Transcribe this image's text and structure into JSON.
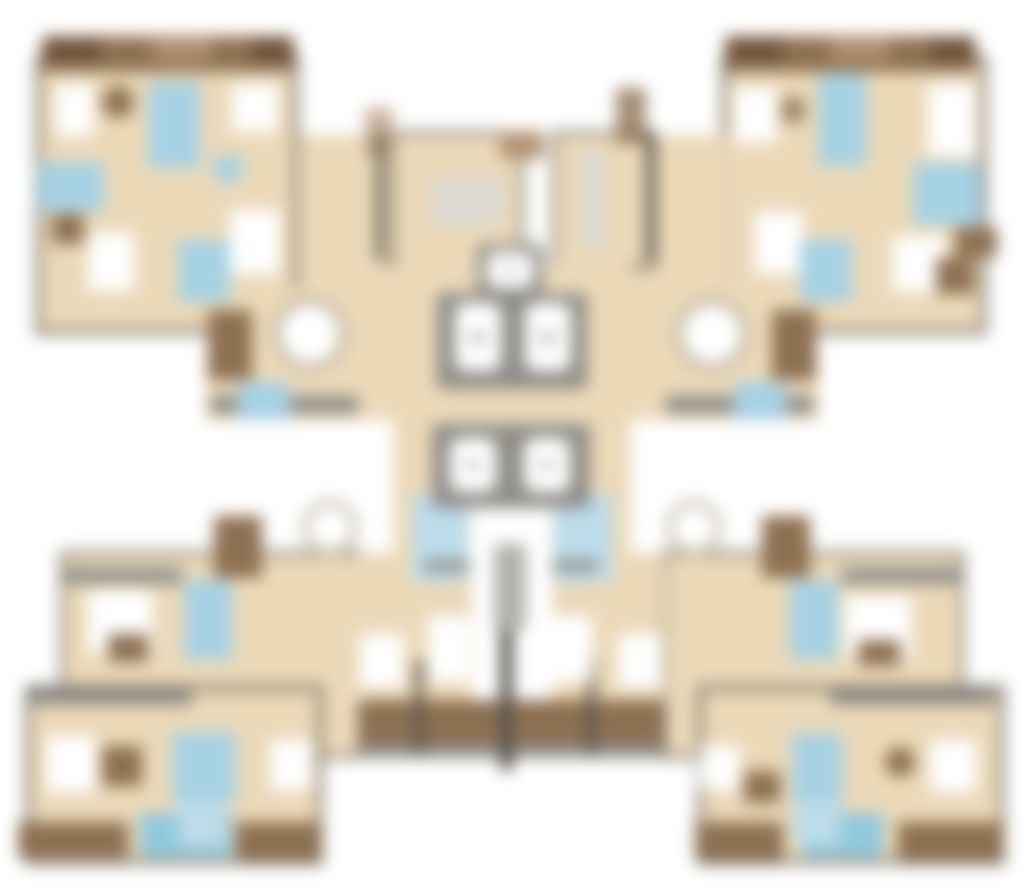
{
  "meta": {
    "title": "Blurred residential tower floor plan",
    "description": "Heavily blurred architectural floor plan: four corner apartment units around a central elevator and stair core. No legible text is rendered in the image.",
    "legible_text": []
  },
  "canvas": {
    "width": 1024,
    "height": 896,
    "background": "#ffffff",
    "blur_px": 8
  },
  "palette": {
    "white": "#ffffff",
    "beige": "#ebd9b8",
    "brown": "#8d7051",
    "dkbrown": "#6e5339",
    "tan": "#b29372",
    "blue": "#a7d2e4",
    "blue2": "#8fc8de",
    "blue3": "#bcdcea",
    "gray": "#8f8d88",
    "gray2": "#b3b1ac",
    "lgray": "#dcdad2",
    "wall": "#6e685d",
    "wall2": "#57534b",
    "ring": "#b9af99"
  },
  "legend": {
    "beige": "apartment floor area",
    "white": "rooms / bedrooms / elevator cabs",
    "blue": "bathrooms and wet areas",
    "brown": "terraces, balconies, furniture",
    "gray": "core walls, railings, stair flight"
  },
  "shapes": [
    {
      "n": "tl-corner-unit-floor",
      "t": "r",
      "x": 38,
      "y": 58,
      "w": 258,
      "h": 274,
      "f": "beige",
      "s": "wall",
      "sw": 5
    },
    {
      "n": "tr-corner-unit-floor",
      "t": "r",
      "x": 724,
      "y": 58,
      "w": 260,
      "h": 274,
      "f": "beige",
      "s": "wall",
      "sw": 5
    },
    {
      "n": "tl-extension-floor-a",
      "t": "r",
      "x": 298,
      "y": 135,
      "w": 96,
      "h": 152,
      "f": "beige"
    },
    {
      "n": "tl-extension-floor-b",
      "t": "r",
      "x": 206,
      "y": 287,
      "w": 188,
      "h": 133,
      "f": "beige"
    },
    {
      "n": "tr-extension-floor-a",
      "t": "r",
      "x": 630,
      "y": 135,
      "w": 96,
      "h": 152,
      "f": "beige"
    },
    {
      "n": "tr-extension-floor-b",
      "t": "r",
      "x": 630,
      "y": 287,
      "w": 188,
      "h": 133,
      "f": "beige"
    },
    {
      "n": "center-top-left-floor",
      "t": "r",
      "x": 392,
      "y": 133,
      "w": 130,
      "h": 134,
      "f": "beige",
      "s": "wall",
      "sw": 4
    },
    {
      "n": "center-top-right-floor",
      "t": "r",
      "x": 554,
      "y": 133,
      "w": 100,
      "h": 134,
      "f": "beige",
      "s": "wall",
      "sw": 4
    },
    {
      "n": "center-core-floor",
      "t": "r",
      "x": 394,
      "y": 264,
      "w": 236,
      "h": 296,
      "f": "beige"
    },
    {
      "n": "bl-intermediate-floor",
      "t": "r",
      "x": 62,
      "y": 553,
      "w": 298,
      "h": 204,
      "f": "beige",
      "s": "wall",
      "sw": 4
    },
    {
      "n": "br-intermediate-floor",
      "t": "r",
      "x": 664,
      "y": 553,
      "w": 298,
      "h": 204,
      "f": "beige",
      "s": "wall",
      "sw": 4
    },
    {
      "n": "bc-left-unit-floor",
      "t": "r",
      "x": 358,
      "y": 553,
      "w": 114,
      "h": 150,
      "f": "beige"
    },
    {
      "n": "bc-right-unit-floor",
      "t": "r",
      "x": 552,
      "y": 553,
      "w": 112,
      "h": 150,
      "f": "beige"
    },
    {
      "n": "bl-corner-unit-floor",
      "t": "r",
      "x": 28,
      "y": 688,
      "w": 292,
      "h": 174,
      "f": "beige",
      "s": "wall",
      "sw": 5
    },
    {
      "n": "br-corner-unit-floor",
      "t": "r",
      "x": 700,
      "y": 688,
      "w": 302,
      "h": 174,
      "f": "beige",
      "s": "wall",
      "sw": 5
    },
    {
      "n": "tl-terrace-band",
      "t": "r",
      "x": 42,
      "y": 36,
      "w": 250,
      "h": 36,
      "f": "brown"
    },
    {
      "n": "tl-terrace-dark-left",
      "t": "r",
      "x": 45,
      "y": 38,
      "w": 55,
      "h": 24,
      "f": "dkbrown"
    },
    {
      "n": "tl-terrace-light-mid",
      "t": "r",
      "x": 152,
      "y": 40,
      "w": 60,
      "h": 20,
      "f": "tan"
    },
    {
      "n": "tl-terrace-dark-right",
      "t": "r",
      "x": 252,
      "y": 38,
      "w": 42,
      "h": 24,
      "f": "dkbrown"
    },
    {
      "n": "tr-terrace-band",
      "t": "r",
      "x": 725,
      "y": 36,
      "w": 250,
      "h": 36,
      "f": "brown"
    },
    {
      "n": "tr-terrace-dark-left",
      "t": "r",
      "x": 728,
      "y": 38,
      "w": 55,
      "h": 24,
      "f": "dkbrown"
    },
    {
      "n": "tr-terrace-light-mid",
      "t": "r",
      "x": 830,
      "y": 40,
      "w": 60,
      "h": 20,
      "f": "tan"
    },
    {
      "n": "tr-terrace-dark-right",
      "t": "r",
      "x": 930,
      "y": 38,
      "w": 45,
      "h": 24,
      "f": "dkbrown"
    },
    {
      "n": "tl-balcony-block",
      "t": "r",
      "x": 208,
      "y": 310,
      "w": 44,
      "h": 70,
      "f": "brown"
    },
    {
      "n": "tr-balcony-block",
      "t": "r",
      "x": 772,
      "y": 310,
      "w": 44,
      "h": 70,
      "f": "brown"
    },
    {
      "n": "tl-railing",
      "t": "r",
      "x": 210,
      "y": 396,
      "w": 148,
      "h": 18,
      "f": "gray"
    },
    {
      "n": "tr-railing",
      "t": "r",
      "x": 666,
      "y": 396,
      "w": 148,
      "h": 18,
      "f": "gray"
    },
    {
      "n": "ct-deco-left",
      "t": "r",
      "x": 365,
      "y": 108,
      "w": 28,
      "h": 48,
      "f": "tan",
      "o": 0.7
    },
    {
      "n": "ct-deco-right",
      "t": "r",
      "x": 616,
      "y": 88,
      "w": 30,
      "h": 56,
      "f": "brown",
      "o": 0.8
    },
    {
      "n": "ct-top-brown-mark",
      "t": "r",
      "x": 500,
      "y": 131,
      "w": 44,
      "h": 28,
      "f": "tan"
    },
    {
      "n": "ct-wall-left",
      "t": "r",
      "x": 376,
      "y": 133,
      "w": 7,
      "h": 128,
      "f": "wall2"
    },
    {
      "n": "ct-wall-right",
      "t": "r",
      "x": 646,
      "y": 133,
      "w": 7,
      "h": 128,
      "f": "wall2"
    },
    {
      "n": "bl-intermediate-top-wall",
      "t": "r",
      "x": 62,
      "y": 568,
      "w": 120,
      "h": 16,
      "f": "gray"
    },
    {
      "n": "br-intermediate-top-wall",
      "t": "r",
      "x": 842,
      "y": 568,
      "w": 120,
      "h": 16,
      "f": "gray"
    },
    {
      "n": "bl-corner-top-wall",
      "t": "r",
      "x": 28,
      "y": 690,
      "w": 164,
      "h": 15,
      "f": "gray"
    },
    {
      "n": "br-corner-top-wall",
      "t": "r",
      "x": 830,
      "y": 690,
      "w": 164,
      "h": 15,
      "f": "gray"
    },
    {
      "n": "bc-balcony-band",
      "t": "r",
      "x": 360,
      "y": 700,
      "w": 302,
      "h": 44,
      "f": "brown"
    },
    {
      "n": "bc-railing",
      "t": "r",
      "x": 360,
      "y": 744,
      "w": 302,
      "h": 14,
      "f": "gray"
    },
    {
      "n": "bc-mullion-left",
      "t": "r",
      "x": 414,
      "y": 660,
      "w": 10,
      "h": 94,
      "f": "wall2",
      "o": 0.8
    },
    {
      "n": "bc-mullion-right",
      "t": "r",
      "x": 586,
      "y": 660,
      "w": 10,
      "h": 94,
      "f": "wall2",
      "o": 0.8
    },
    {
      "n": "bc-party-wall-divider",
      "t": "r",
      "x": 500,
      "y": 556,
      "w": 13,
      "h": 214,
      "f": "wall2"
    },
    {
      "n": "bl-bottom-band-brown-1",
      "t": "r",
      "x": 18,
      "y": 822,
      "w": 110,
      "h": 36,
      "f": "brown"
    },
    {
      "n": "bl-bottom-band-blue",
      "t": "r",
      "x": 140,
      "y": 813,
      "w": 92,
      "h": 44,
      "f": "blue2"
    },
    {
      "n": "bl-bottom-band-brown-2",
      "t": "r",
      "x": 236,
      "y": 822,
      "w": 84,
      "h": 38,
      "f": "brown"
    },
    {
      "n": "br-bottom-band-brown-1",
      "t": "r",
      "x": 695,
      "y": 822,
      "w": 88,
      "h": 38,
      "f": "brown"
    },
    {
      "n": "br-bottom-band-blue",
      "t": "r",
      "x": 803,
      "y": 813,
      "w": 80,
      "h": 44,
      "f": "blue2"
    },
    {
      "n": "br-bottom-band-brown-2",
      "t": "r",
      "x": 898,
      "y": 822,
      "w": 106,
      "h": 38,
      "f": "brown"
    },
    {
      "n": "tl-bedroom-1",
      "t": "r",
      "x": 56,
      "y": 84,
      "w": 38,
      "h": 52,
      "f": "white"
    },
    {
      "n": "tl-bathroom-1",
      "t": "r",
      "x": 148,
      "y": 82,
      "w": 52,
      "h": 86,
      "f": "blue"
    },
    {
      "n": "tl-bedroom-2",
      "t": "r",
      "x": 232,
      "y": 84,
      "w": 46,
      "h": 48,
      "f": "white"
    },
    {
      "n": "tl-wet-small",
      "t": "r",
      "x": 214,
      "y": 156,
      "w": 28,
      "h": 26,
      "f": "blue"
    },
    {
      "n": "tl-bathroom-2",
      "t": "r",
      "x": 38,
      "y": 162,
      "w": 66,
      "h": 50,
      "f": "blue"
    },
    {
      "n": "tl-bedroom-3",
      "t": "r",
      "x": 88,
      "y": 233,
      "w": 46,
      "h": 58,
      "f": "white"
    },
    {
      "n": "tl-ext-bedroom",
      "t": "r",
      "x": 230,
      "y": 210,
      "w": 50,
      "h": 64,
      "f": "white"
    },
    {
      "n": "tl-ext-bathroom",
      "t": "r",
      "x": 178,
      "y": 240,
      "w": 52,
      "h": 62,
      "f": "blue"
    },
    {
      "n": "tl-ext-wet-area",
      "t": "r",
      "x": 238,
      "y": 382,
      "w": 52,
      "h": 38,
      "f": "blue"
    },
    {
      "n": "tr-bedroom-1",
      "t": "r",
      "x": 733,
      "y": 88,
      "w": 44,
      "h": 54,
      "f": "white"
    },
    {
      "n": "tr-bathroom-1",
      "t": "r",
      "x": 818,
      "y": 74,
      "w": 48,
      "h": 92,
      "f": "blue"
    },
    {
      "n": "tr-bedroom-2",
      "t": "r",
      "x": 928,
      "y": 84,
      "w": 48,
      "h": 72,
      "f": "white"
    },
    {
      "n": "tr-bathroom-2",
      "t": "r",
      "x": 913,
      "y": 163,
      "w": 68,
      "h": 62,
      "f": "blue"
    },
    {
      "n": "tr-bedroom-3",
      "t": "r",
      "x": 893,
      "y": 236,
      "w": 52,
      "h": 56,
      "f": "white"
    },
    {
      "n": "tr-ext-bedroom",
      "t": "r",
      "x": 755,
      "y": 212,
      "w": 48,
      "h": 62,
      "f": "white"
    },
    {
      "n": "tr-ext-bathroom",
      "t": "r",
      "x": 800,
      "y": 240,
      "w": 52,
      "h": 62,
      "f": "blue"
    },
    {
      "n": "tr-ext-wet-area",
      "t": "r",
      "x": 734,
      "y": 382,
      "w": 52,
      "h": 38,
      "f": "blue"
    },
    {
      "n": "ct-kitchen-counter",
      "t": "r",
      "x": 432,
      "y": 178,
      "w": 72,
      "h": 48,
      "f": "lgray"
    },
    {
      "n": "ct-corridor-strip",
      "t": "r",
      "x": 580,
      "y": 150,
      "w": 26,
      "h": 98,
      "f": "lgray"
    },
    {
      "n": "stair-wet-left",
      "t": "r",
      "x": 412,
      "y": 494,
      "w": 56,
      "h": 88,
      "f": "blue3"
    },
    {
      "n": "stair-wet-right",
      "t": "r",
      "x": 554,
      "y": 494,
      "w": 58,
      "h": 88,
      "f": "blue3"
    },
    {
      "n": "stairwell",
      "t": "r",
      "x": 470,
      "y": 500,
      "w": 82,
      "h": 74,
      "f": "white"
    },
    {
      "n": "bc-left-bedroom-a",
      "t": "r",
      "x": 360,
      "y": 634,
      "w": 44,
      "h": 54,
      "f": "white"
    },
    {
      "n": "bc-left-bedroom-b",
      "t": "r",
      "x": 428,
      "y": 616,
      "w": 42,
      "h": 66,
      "f": "white"
    },
    {
      "n": "bc-right-bedroom-a",
      "t": "r",
      "x": 550,
      "y": 616,
      "w": 42,
      "h": 66,
      "f": "white"
    },
    {
      "n": "bc-right-bedroom-b",
      "t": "r",
      "x": 618,
      "y": 634,
      "w": 44,
      "h": 54,
      "f": "white"
    },
    {
      "n": "bl-int-bedroom",
      "t": "r",
      "x": 88,
      "y": 590,
      "w": 64,
      "h": 64,
      "f": "white"
    },
    {
      "n": "bl-int-bathroom",
      "t": "r",
      "x": 184,
      "y": 580,
      "w": 48,
      "h": 80,
      "f": "blue"
    },
    {
      "n": "br-int-bedroom",
      "t": "r",
      "x": 845,
      "y": 596,
      "w": 66,
      "h": 62,
      "f": "white"
    },
    {
      "n": "br-int-bathroom",
      "t": "r",
      "x": 790,
      "y": 580,
      "w": 48,
      "h": 80,
      "f": "blue"
    },
    {
      "n": "bl-corner-bedroom-1",
      "t": "r",
      "x": 46,
      "y": 736,
      "w": 50,
      "h": 56,
      "f": "white"
    },
    {
      "n": "bl-corner-bathroom",
      "t": "r",
      "x": 172,
      "y": 732,
      "w": 64,
      "h": 70,
      "f": "blue"
    },
    {
      "n": "bl-corner-wet-lower",
      "t": "r",
      "x": 178,
      "y": 800,
      "w": 48,
      "h": 46,
      "f": "blue3"
    },
    {
      "n": "bl-corner-bedroom-2",
      "t": "r",
      "x": 270,
      "y": 740,
      "w": 42,
      "h": 50,
      "f": "white"
    },
    {
      "n": "br-corner-bedroom-1",
      "t": "r",
      "x": 700,
      "y": 746,
      "w": 40,
      "h": 44,
      "f": "white"
    },
    {
      "n": "br-corner-bathroom",
      "t": "r",
      "x": 792,
      "y": 733,
      "w": 50,
      "h": 72,
      "f": "blue"
    },
    {
      "n": "br-corner-wet-lower",
      "t": "r",
      "x": 794,
      "y": 801,
      "w": 46,
      "h": 44,
      "f": "blue3"
    },
    {
      "n": "br-corner-bedroom-2",
      "t": "r",
      "x": 930,
      "y": 740,
      "w": 46,
      "h": 52,
      "f": "white"
    },
    {
      "n": "tl-desk-furniture",
      "t": "c",
      "cx": 118,
      "cy": 102,
      "r": 16,
      "f": "brown"
    },
    {
      "n": "tl-furniture-2",
      "t": "r",
      "x": 52,
      "y": 214,
      "w": 32,
      "h": 30,
      "f": "brown"
    },
    {
      "n": "tr-desk-furniture",
      "t": "r",
      "x": 782,
      "y": 98,
      "w": 22,
      "h": 24,
      "f": "brown",
      "o": 0.85
    },
    {
      "n": "tr-furniture-2",
      "t": "r",
      "x": 955,
      "y": 227,
      "w": 42,
      "h": 30,
      "f": "brown"
    },
    {
      "n": "tr-furniture-3",
      "t": "r",
      "x": 936,
      "y": 258,
      "w": 38,
      "h": 36,
      "f": "brown"
    },
    {
      "n": "tl-round-table",
      "t": "c",
      "cx": 310,
      "cy": 334,
      "r": 33,
      "f": "white",
      "s": "ring",
      "sw": 7
    },
    {
      "n": "tr-round-table",
      "t": "c",
      "cx": 712,
      "cy": 334,
      "r": 33,
      "f": "white",
      "s": "ring",
      "sw": 7
    },
    {
      "n": "bl-round-table",
      "t": "c",
      "cx": 330,
      "cy": 528,
      "r": 25,
      "f": "white",
      "s": "ring",
      "sw": 6,
      "o": 0.9
    },
    {
      "n": "br-round-table",
      "t": "c",
      "cx": 694,
      "cy": 528,
      "r": 25,
      "f": "white",
      "s": "ring",
      "sw": 6,
      "o": 0.9
    },
    {
      "n": "bl-balcony-block",
      "t": "r",
      "x": 214,
      "y": 516,
      "w": 48,
      "h": 62,
      "f": "brown"
    },
    {
      "n": "br-balcony-block",
      "t": "r",
      "x": 762,
      "y": 516,
      "w": 48,
      "h": 62,
      "f": "brown"
    },
    {
      "n": "bl-int-furniture",
      "t": "r",
      "x": 108,
      "y": 634,
      "w": 40,
      "h": 28,
      "f": "brown"
    },
    {
      "n": "br-int-furniture",
      "t": "r",
      "x": 858,
      "y": 640,
      "w": 42,
      "h": 26,
      "f": "brown"
    },
    {
      "n": "bl-corner-furniture",
      "t": "r",
      "x": 102,
      "y": 746,
      "w": 40,
      "h": 40,
      "f": "brown"
    },
    {
      "n": "br-corner-furniture",
      "t": "r",
      "x": 744,
      "y": 771,
      "w": 36,
      "h": 32,
      "f": "brown"
    },
    {
      "n": "br-corner-round-table",
      "t": "c",
      "cx": 900,
      "cy": 762,
      "r": 15,
      "f": "brown"
    },
    {
      "n": "elevator-top-frame",
      "t": "r",
      "x": 477,
      "y": 244,
      "w": 66,
      "h": 52,
      "f": "gray",
      "rx": 6
    },
    {
      "n": "elevator-top-cab",
      "t": "r",
      "x": 487,
      "y": 252,
      "w": 46,
      "h": 36,
      "f": "white",
      "rx": 9
    },
    {
      "n": "elevator-top-dot",
      "t": "c",
      "cx": 510,
      "cy": 270,
      "r": 5,
      "f": "gray2"
    },
    {
      "n": "elevator-bank1-frame",
      "t": "r",
      "x": 437,
      "y": 293,
      "w": 150,
      "h": 96,
      "f": "gray",
      "rx": 4
    },
    {
      "n": "elevator-bank1-cab-left",
      "t": "r",
      "x": 455,
      "y": 303,
      "w": 46,
      "h": 68,
      "f": "white",
      "rx": 11
    },
    {
      "n": "elevator-bank1-cab-right",
      "t": "r",
      "x": 525,
      "y": 303,
      "w": 46,
      "h": 68,
      "f": "white",
      "rx": 11
    },
    {
      "n": "elevator-bank1-dot-left",
      "t": "c",
      "cx": 478,
      "cy": 338,
      "r": 7,
      "f": "gray2"
    },
    {
      "n": "elevator-bank1-dot-right",
      "t": "c",
      "cx": 548,
      "cy": 338,
      "r": 7,
      "f": "gray2"
    },
    {
      "n": "elevator-bank2-frame",
      "t": "r",
      "x": 432,
      "y": 424,
      "w": 158,
      "h": 84,
      "f": "gray",
      "rx": 4
    },
    {
      "n": "elevator-bank2-cab-left",
      "t": "r",
      "x": 450,
      "y": 438,
      "w": 46,
      "h": 54,
      "f": "white",
      "rx": 11
    },
    {
      "n": "elevator-bank2-cab-right",
      "t": "r",
      "x": 524,
      "y": 438,
      "w": 46,
      "h": 54,
      "f": "white",
      "rx": 11
    },
    {
      "n": "elevator-bank2-dot-left",
      "t": "c",
      "cx": 473,
      "cy": 465,
      "r": 6,
      "f": "gray2"
    },
    {
      "n": "elevator-bank2-dot-right",
      "t": "c",
      "cx": 547,
      "cy": 465,
      "r": 6,
      "f": "gray2"
    },
    {
      "n": "stair-flight",
      "t": "r",
      "x": 494,
      "y": 544,
      "w": 32,
      "h": 86,
      "f": "gray2"
    },
    {
      "n": "stair-edge-left",
      "t": "r",
      "x": 424,
      "y": 560,
      "w": 46,
      "h": 11,
      "f": "gray"
    },
    {
      "n": "stair-edge-right",
      "t": "r",
      "x": 552,
      "y": 560,
      "w": 46,
      "h": 11,
      "f": "gray"
    }
  ]
}
